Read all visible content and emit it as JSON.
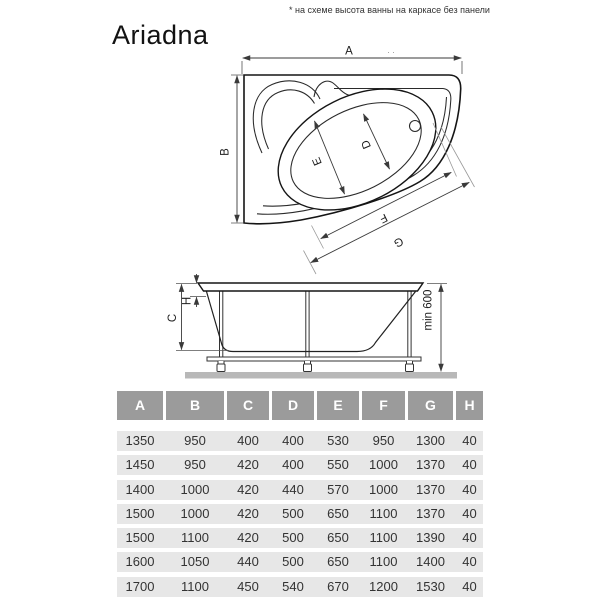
{
  "note": "* на схеме высота ванны на каркасе без панели",
  "title": "Ariadna",
  "diagram": {
    "top_view": {
      "dim_a": "A",
      "dim_b": "B",
      "dim_d": "D",
      "dim_e": "E",
      "dim_f": "F",
      "dim_g": "G",
      "dots": ". ."
    },
    "side_view": {
      "dim_c": "C",
      "dim_h": "H",
      "min_height": "min 600"
    }
  },
  "table": {
    "headers": [
      "A",
      "B",
      "C",
      "D",
      "E",
      "F",
      "G",
      "H"
    ],
    "rows": [
      [
        "1350",
        "950",
        "400",
        "400",
        "530",
        "950",
        "1300",
        "40"
      ],
      [
        "1450",
        "950",
        "420",
        "400",
        "550",
        "1000",
        "1370",
        "40"
      ],
      [
        "1400",
        "1000",
        "420",
        "440",
        "570",
        "1000",
        "1370",
        "40"
      ],
      [
        "1500",
        "1000",
        "420",
        "500",
        "650",
        "1100",
        "1370",
        "40"
      ],
      [
        "1500",
        "1100",
        "420",
        "500",
        "650",
        "1100",
        "1390",
        "40"
      ],
      [
        "1600",
        "1050",
        "440",
        "500",
        "650",
        "1100",
        "1400",
        "40"
      ],
      [
        "1700",
        "1100",
        "450",
        "540",
        "670",
        "1200",
        "1530",
        "40"
      ]
    ]
  },
  "colors": {
    "header_bg": "#9b9b9b",
    "header_text": "#ffffff",
    "row_bg": "#e7e7e7",
    "row_text": "#333333",
    "outline": "#151515",
    "dim_line": "#3a3a3a",
    "ground": "#b8b8b8"
  }
}
